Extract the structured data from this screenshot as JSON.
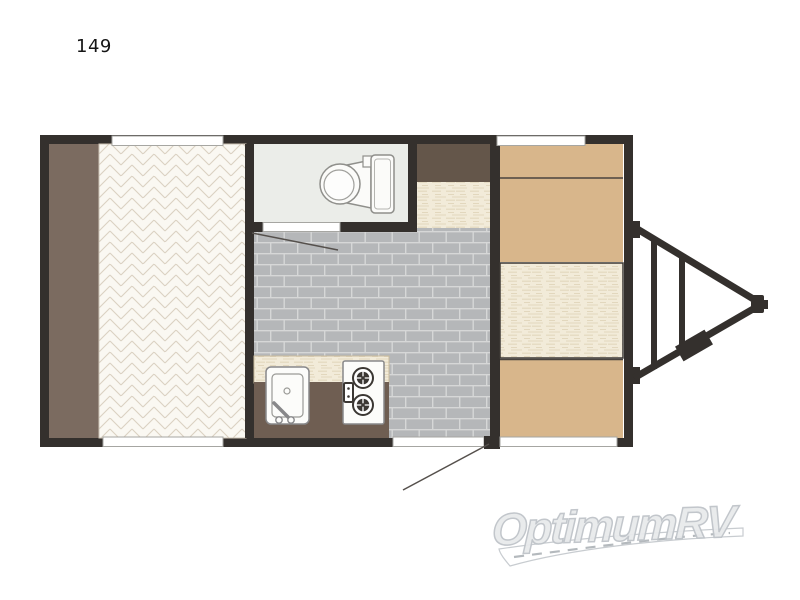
{
  "page": {
    "unit_number": "149",
    "background": "#ffffff"
  },
  "watermark": {
    "brand_text": "OptimumRV",
    "text_color": "#e8eaec",
    "outline_color": "#bfc4c9",
    "road_graphic": "road-swoosh-with-dashed-centerline"
  },
  "floorplan": {
    "view": "top-down single-axle travel trailer layout, hitch on right",
    "colors": {
      "wall": "#34302d",
      "side_strip_brown": "#7b6b60",
      "wardrobe_brown": "#64564a",
      "counter_base_brown": "#6f5e52",
      "cabinet_tan": "#d8b68b",
      "cabinet_edge": "#4a443e",
      "bathroom_floor": "#ebede9",
      "brick_floor": "#b5b7b9",
      "brick_mortar": "#d6d7d7",
      "bed_fill": "#faf8f2",
      "bed_lines": "#dad1c2",
      "cream_fill": "#f2ebd9",
      "cream_streaks": "#e2d7bd",
      "fixture_fill": "#fcfcfa",
      "fixture_stroke": "#8d8d89",
      "burner_dark": "#3b3733",
      "opening_fill": "#ffffff",
      "opening_stroke": "#a6a6a2",
      "leader_line": "#55504c",
      "road_edge": "#c8ccd0",
      "road_dash": "#b4b9bd"
    },
    "elements": [
      {
        "name": "side-cabinet-strip",
        "type": "cabinet"
      },
      {
        "name": "rear-bed",
        "type": "herringbone-mattress"
      },
      {
        "name": "bathroom",
        "type": "room"
      },
      {
        "name": "toilet",
        "type": "fixture"
      },
      {
        "name": "bathroom-door-opening",
        "type": "door"
      },
      {
        "name": "wardrobe-cabinet",
        "type": "cabinet"
      },
      {
        "name": "counter-column",
        "type": "counter"
      },
      {
        "name": "main-floor",
        "type": "brick-tile-floor"
      },
      {
        "name": "kitchen-counter",
        "type": "counter"
      },
      {
        "name": "kitchen-sink",
        "type": "fixture"
      },
      {
        "name": "two-burner-stove",
        "type": "fixture"
      },
      {
        "name": "front-cabinet-top",
        "type": "cabinet"
      },
      {
        "name": "front-bench-cushion",
        "type": "seat"
      },
      {
        "name": "front-cabinet-bottom",
        "type": "cabinet"
      },
      {
        "name": "window-rear-top",
        "type": "window"
      },
      {
        "name": "window-rear-bottom",
        "type": "window"
      },
      {
        "name": "window-front-top",
        "type": "window"
      },
      {
        "name": "window-front-bottom",
        "type": "window"
      },
      {
        "name": "entry-door-opening",
        "type": "door"
      },
      {
        "name": "a-frame-tongue",
        "type": "hitch"
      },
      {
        "name": "tongue-box",
        "type": "hitch-accessory"
      },
      {
        "name": "coupler",
        "type": "hitch"
      }
    ]
  }
}
